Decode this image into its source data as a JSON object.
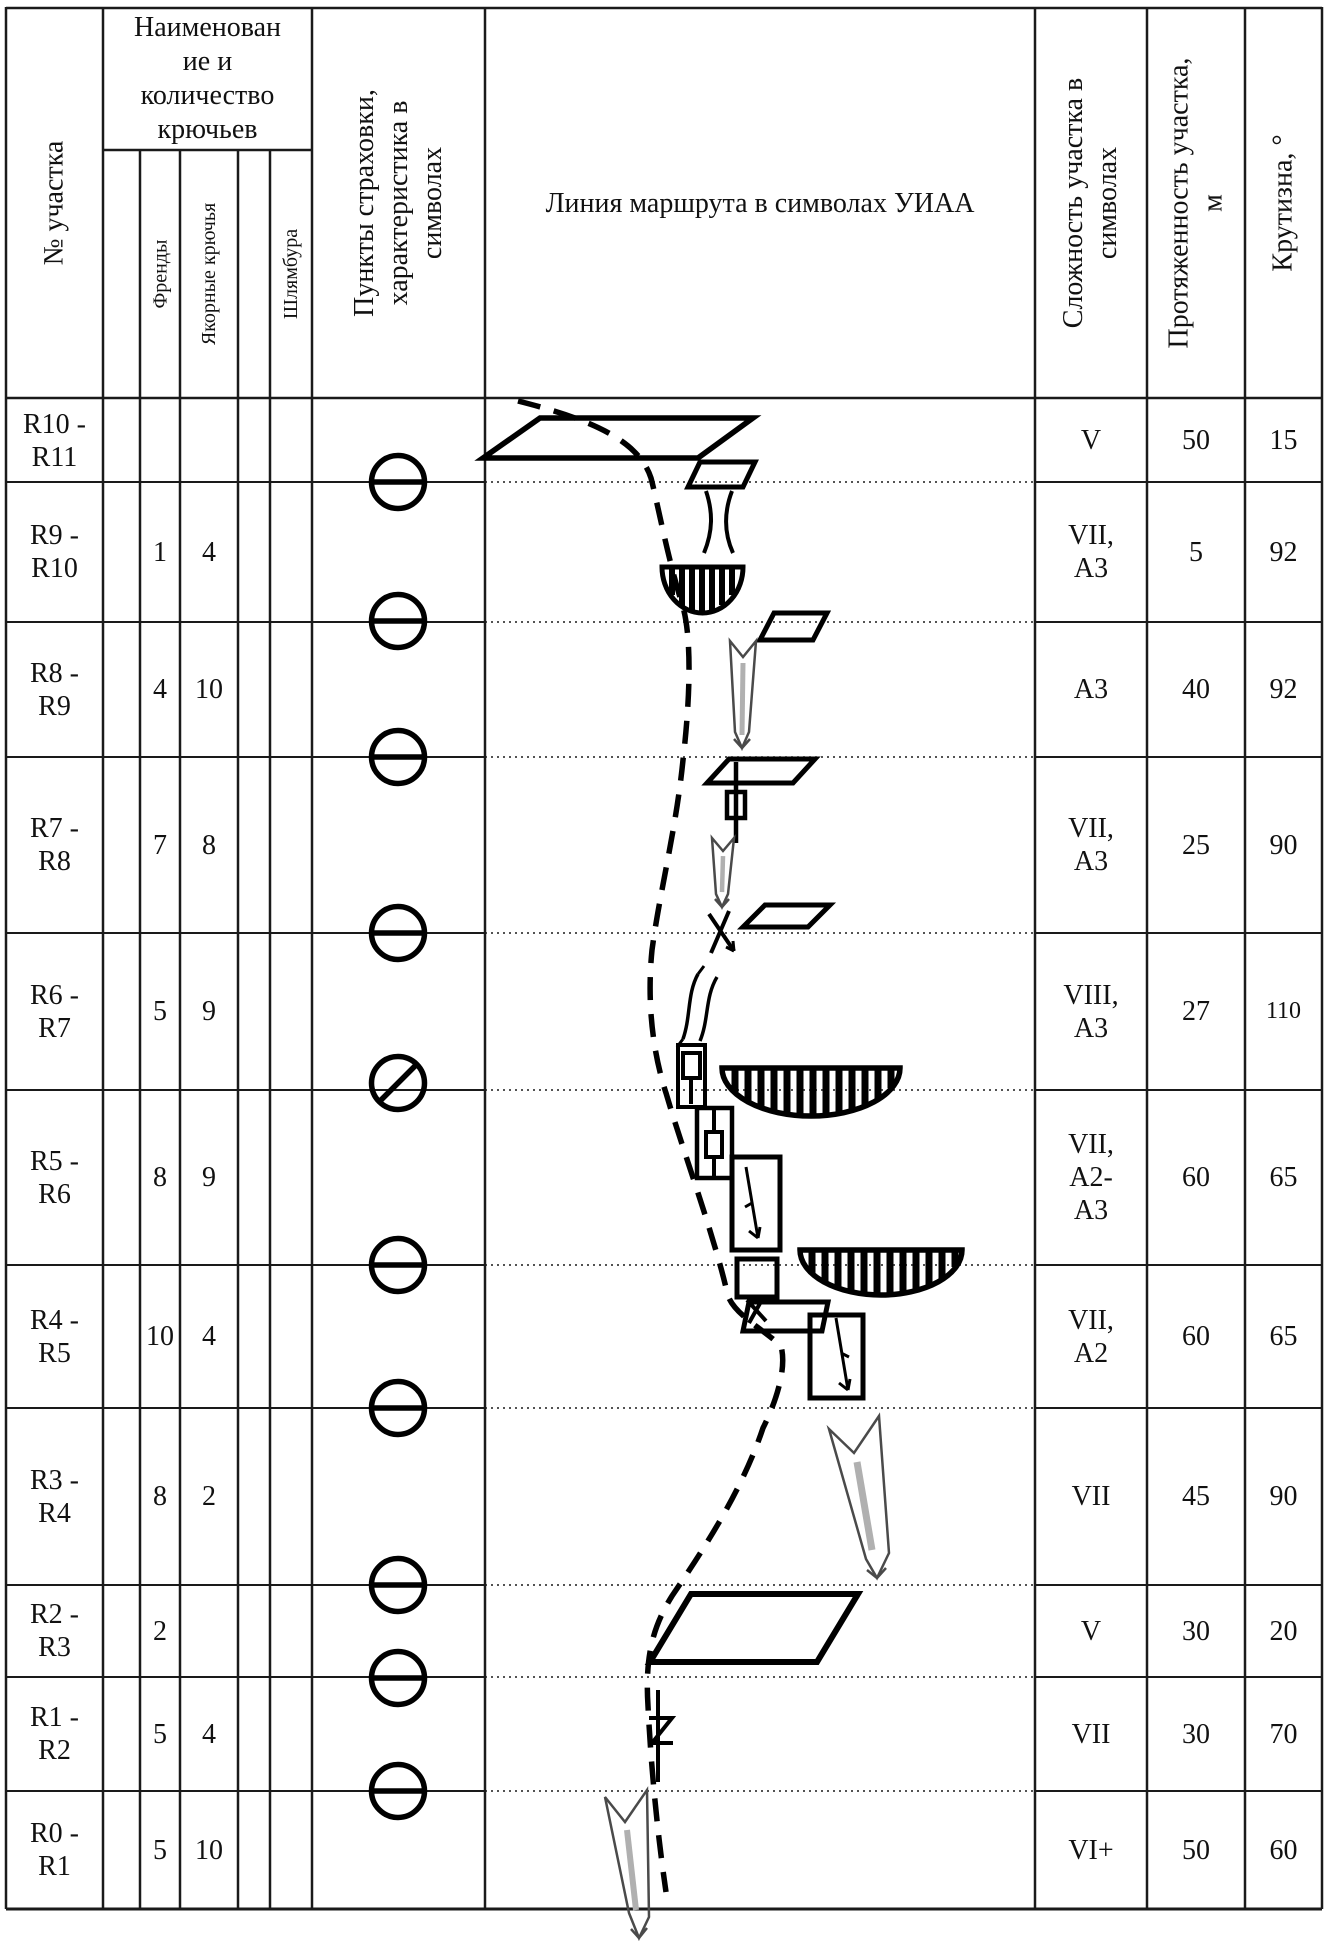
{
  "header": {
    "section_col": "№ участка",
    "gear_group": "Наименован\nие и\nколичество\nкрючьев",
    "gear_subcols": {
      "sub1": "",
      "friends": "Френды",
      "anchors": "Якорные крючья",
      "sub4": "",
      "bolts": "Шлямбура"
    },
    "belay_col": "Пункты страховки,\nхарактеристика в\nсимволах",
    "route_col": "Линия маршрута в символах УИАА",
    "difficulty_col": "Сложность участка в\nсимволах",
    "length_col": "Протяженность участка,\nм",
    "steepness_col": "Крутизна, °"
  },
  "rows": [
    {
      "section": "R10 -\nR11",
      "friends": "",
      "anchors": "",
      "difficulty": "V",
      "length": "50",
      "steepness": "15"
    },
    {
      "section": "R9 -\nR10",
      "friends": "1",
      "anchors": "4",
      "difficulty": "VII,\nA3",
      "length": "5",
      "steepness": "92"
    },
    {
      "section": "R8 -\nR9",
      "friends": "4",
      "anchors": "10",
      "difficulty": "A3",
      "length": "40",
      "steepness": "92"
    },
    {
      "section": "R7 -\nR8",
      "friends": "7",
      "anchors": "8",
      "difficulty": "VII,\nA3",
      "length": "25",
      "steepness": "90"
    },
    {
      "section": "R6 -\nR7",
      "friends": "5",
      "anchors": "9",
      "difficulty": "VIII,\nA3",
      "length": "27",
      "steepness": "110"
    },
    {
      "section": "R5 -\nR6",
      "friends": "8",
      "anchors": "9",
      "difficulty": "VII,\nA2-\nA3",
      "length": "60",
      "steepness": "65"
    },
    {
      "section": "R4 -\nR5",
      "friends": "10",
      "anchors": "4",
      "difficulty": "VII,\nA2",
      "length": "60",
      "steepness": "65"
    },
    {
      "section": "R3 -\nR4",
      "friends": "8",
      "anchors": "2",
      "difficulty": "VII",
      "length": "45",
      "steepness": "90"
    },
    {
      "section": "R2 -\nR3",
      "friends": "2",
      "anchors": "",
      "difficulty": "V",
      "length": "30",
      "steepness": "20"
    },
    {
      "section": "R1 -\nR2",
      "friends": "5",
      "anchors": "4",
      "difficulty": "VII",
      "length": "30",
      "steepness": "70"
    },
    {
      "section": "R0 -\nR1",
      "friends": "5",
      "anchors": "10",
      "difficulty": "VI+",
      "length": "50",
      "steepness": "60"
    }
  ],
  "route": {
    "line_style": "dashed",
    "belay_stations": [
      {
        "at": "R10",
        "symbol": "circle-horizontal-bar"
      },
      {
        "at": "R9",
        "symbol": "circle-horizontal-bar"
      },
      {
        "at": "R8",
        "symbol": "circle-horizontal-bar"
      },
      {
        "at": "R7",
        "symbol": "circle-horizontal-bar"
      },
      {
        "at": "R6",
        "symbol": "circle-diagonal-bar"
      },
      {
        "at": "R5",
        "symbol": "circle-horizontal-bar"
      },
      {
        "at": "R4",
        "symbol": "circle-horizontal-bar"
      },
      {
        "at": "R3",
        "symbol": "circle-horizontal-bar"
      },
      {
        "at": "R2",
        "symbol": "circle-horizontal-bar"
      },
      {
        "at": "R1",
        "symbol": "circle-horizontal-bar"
      }
    ],
    "uiaa_symbols": [
      "ledge",
      "narrowing-crack",
      "roof-overhang",
      "crack-arrow",
      "piton-box",
      "chockstone",
      "cross-crack",
      "inclined-crack-box",
      "zigzag-crack",
      "rappel-arrow"
    ]
  },
  "colors": {
    "ink": "#111111",
    "arrow_outline": "#4a4a4a",
    "arrow_core": "#b0b0b0"
  }
}
